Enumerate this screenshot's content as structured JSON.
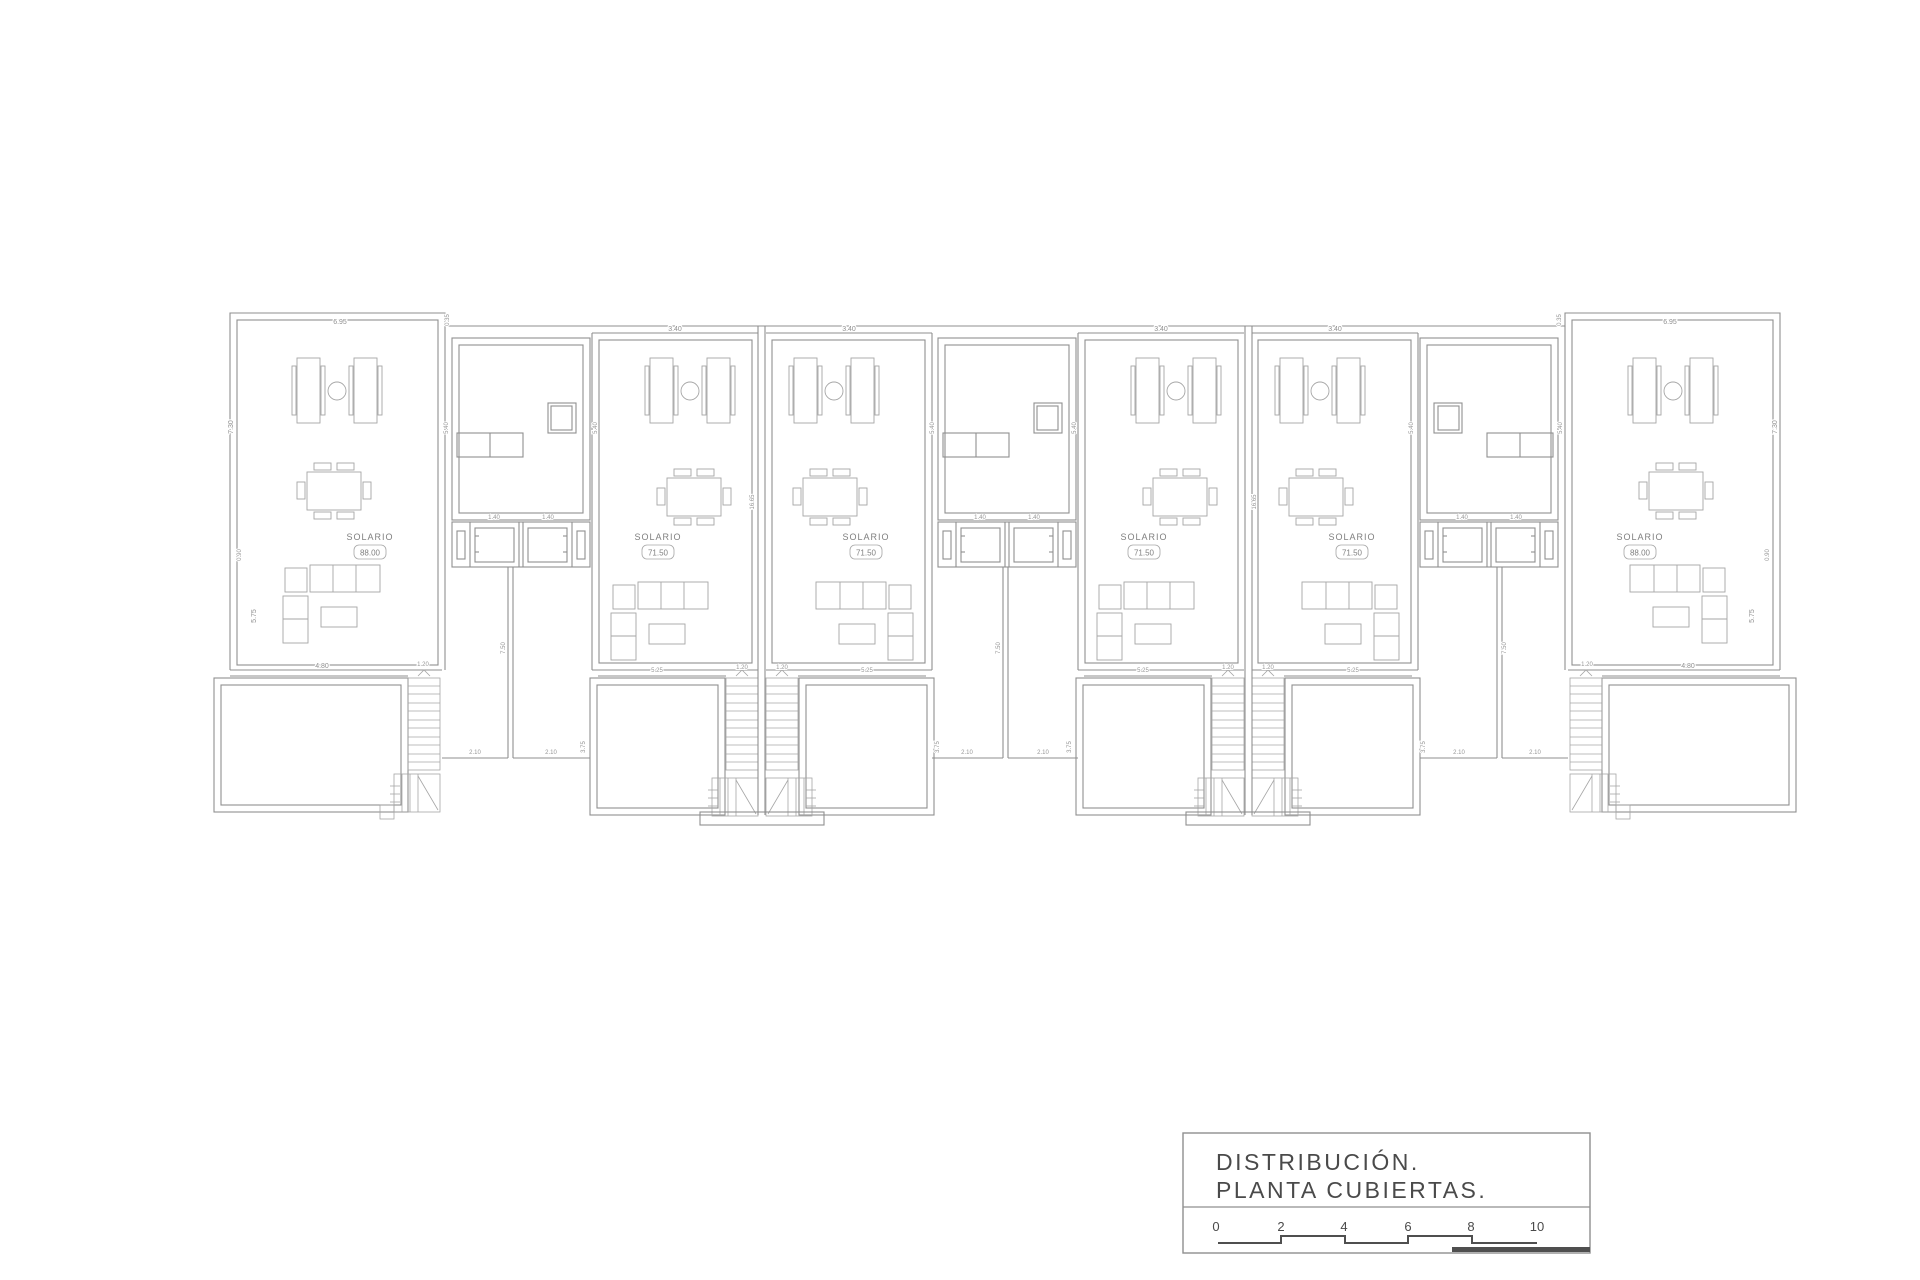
{
  "drawing": {
    "type": "architectural-roof-plan"
  },
  "units": [
    {
      "label": "SOLARIO",
      "area": "88.00"
    },
    {
      "label": "SOLARIO",
      "area": "71.50"
    },
    {
      "label": "SOLARIO",
      "area": "71.50"
    },
    {
      "label": "SOLARIO",
      "area": "71.50"
    },
    {
      "label": "SOLARIO",
      "area": "71.50"
    },
    {
      "label": "SOLARIO",
      "area": "88.00"
    }
  ],
  "dims": {
    "end_width": "6.95",
    "mid_width": "3.40",
    "step": "0.35",
    "side_height": "7.30",
    "side_step": "0.90",
    "terrace_side": "5.75",
    "room_side": "5.40",
    "party_height": "16.65",
    "strip_height": "7.50",
    "lower_width": "4.80",
    "stair_width": "1.20",
    "lower_room_width": "5.25",
    "lower_room_height": "3.75",
    "gap_width": "2.10",
    "ac_width": "1.40"
  },
  "title_block": {
    "line1": "DISTRIBUCIÓN.",
    "line2": "PLANTA CUBIERTAS."
  },
  "scale": {
    "ticks": [
      "0",
      "2",
      "4",
      "6",
      "8",
      "10"
    ]
  }
}
